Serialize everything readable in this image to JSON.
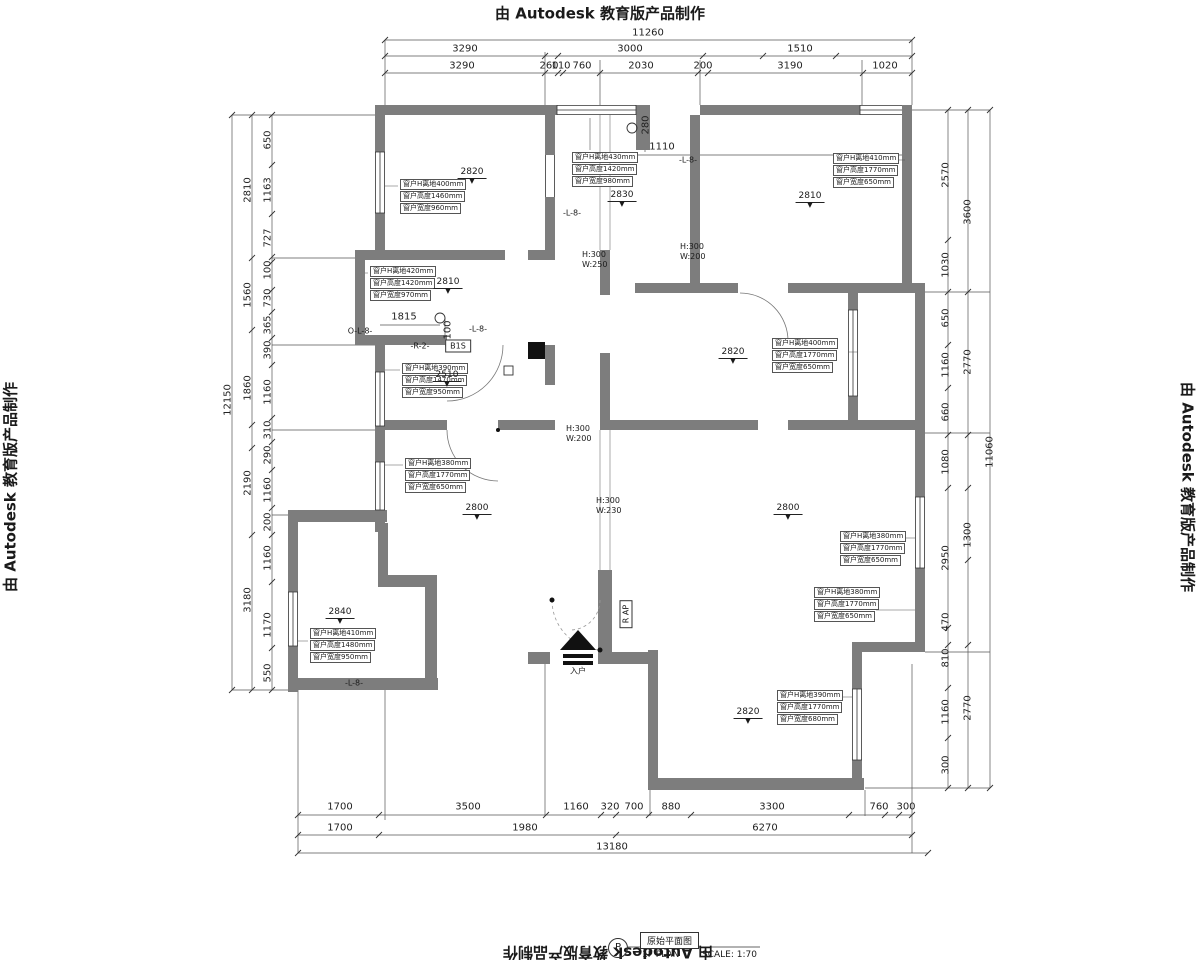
{
  "stamp_text": "由 Autodesk 教育版产品制作",
  "title_block": {
    "circle_letter": "P",
    "drawing_name": "原始平面图",
    "plan_label": "1F PLAN",
    "scale_label": "SCALE: 1:70"
  },
  "colors": {
    "wall": "#7d7d7d",
    "line": "#555555",
    "text": "#1a1a1a"
  },
  "dimensions": {
    "top": [
      {
        "t": "11260",
        "x": 648,
        "y": 33
      },
      {
        "t": "3290",
        "x": 465,
        "y": 49
      },
      {
        "t": "3000",
        "x": 630,
        "y": 49
      },
      {
        "t": "1510",
        "x": 800,
        "y": 49
      },
      {
        "t": "3290",
        "x": 462,
        "y": 66
      },
      {
        "t": "260",
        "x": 549,
        "y": 66
      },
      {
        "t": "110",
        "x": 561,
        "y": 66
      },
      {
        "t": "760",
        "x": 582,
        "y": 66
      },
      {
        "t": "2030",
        "x": 641,
        "y": 66
      },
      {
        "t": "200",
        "x": 703,
        "y": 66
      },
      {
        "t": "3190",
        "x": 790,
        "y": 66
      },
      {
        "t": "1020",
        "x": 885,
        "y": 66
      }
    ],
    "left": [
      {
        "t": "12150",
        "x": 228,
        "y": 400,
        "rot": 1
      },
      {
        "t": "2810",
        "x": 248,
        "y": 190,
        "rot": 1
      },
      {
        "t": "1560",
        "x": 248,
        "y": 295,
        "rot": 1
      },
      {
        "t": "1860",
        "x": 248,
        "y": 388,
        "rot": 1
      },
      {
        "t": "2190",
        "x": 248,
        "y": 483,
        "rot": 1
      },
      {
        "t": "3180",
        "x": 248,
        "y": 600,
        "rot": 1
      },
      {
        "t": "650",
        "x": 268,
        "y": 140,
        "rot": 1
      },
      {
        "t": "1163",
        "x": 268,
        "y": 190,
        "rot": 1
      },
      {
        "t": "727",
        "x": 268,
        "y": 238,
        "rot": 1
      },
      {
        "t": "100",
        "x": 268,
        "y": 270,
        "rot": 1
      },
      {
        "t": "730",
        "x": 268,
        "y": 298,
        "rot": 1
      },
      {
        "t": "365",
        "x": 268,
        "y": 325,
        "rot": 1
      },
      {
        "t": "390",
        "x": 268,
        "y": 350,
        "rot": 1
      },
      {
        "t": "1160",
        "x": 268,
        "y": 392,
        "rot": 1
      },
      {
        "t": "310",
        "x": 268,
        "y": 430,
        "rot": 1
      },
      {
        "t": "290",
        "x": 268,
        "y": 455,
        "rot": 1
      },
      {
        "t": "1160",
        "x": 268,
        "y": 490,
        "rot": 1
      },
      {
        "t": "200",
        "x": 268,
        "y": 522,
        "rot": 1
      },
      {
        "t": "1160",
        "x": 268,
        "y": 558,
        "rot": 1
      },
      {
        "t": "1170",
        "x": 268,
        "y": 625,
        "rot": 1
      },
      {
        "t": "550",
        "x": 268,
        "y": 673,
        "rot": 1
      }
    ],
    "right": [
      {
        "t": "11060",
        "x": 990,
        "y": 452,
        "rot": 1
      },
      {
        "t": "3600",
        "x": 968,
        "y": 212,
        "rot": 1
      },
      {
        "t": "2770",
        "x": 968,
        "y": 362,
        "rot": 1
      },
      {
        "t": "1300",
        "x": 968,
        "y": 535,
        "rot": 1
      },
      {
        "t": "2770",
        "x": 968,
        "y": 708,
        "rot": 1
      },
      {
        "t": "2570",
        "x": 946,
        "y": 175,
        "rot": 1
      },
      {
        "t": "1030",
        "x": 946,
        "y": 265,
        "rot": 1
      },
      {
        "t": "650",
        "x": 946,
        "y": 318,
        "rot": 1
      },
      {
        "t": "1160",
        "x": 946,
        "y": 365,
        "rot": 1
      },
      {
        "t": "660",
        "x": 946,
        "y": 412,
        "rot": 1
      },
      {
        "t": "1080",
        "x": 946,
        "y": 462,
        "rot": 1
      },
      {
        "t": "2950",
        "x": 946,
        "y": 558,
        "rot": 1
      },
      {
        "t": "470",
        "x": 946,
        "y": 622,
        "rot": 1
      },
      {
        "t": "810",
        "x": 946,
        "y": 658,
        "rot": 1
      },
      {
        "t": "1160",
        "x": 946,
        "y": 712,
        "rot": 1
      },
      {
        "t": "300",
        "x": 946,
        "y": 765,
        "rot": 1
      }
    ],
    "bottom": [
      {
        "t": "1700",
        "x": 340,
        "y": 807
      },
      {
        "t": "3500",
        "x": 468,
        "y": 807
      },
      {
        "t": "1160",
        "x": 576,
        "y": 807
      },
      {
        "t": "320",
        "x": 610,
        "y": 807
      },
      {
        "t": "700",
        "x": 634,
        "y": 807
      },
      {
        "t": "880",
        "x": 671,
        "y": 807
      },
      {
        "t": "3300",
        "x": 772,
        "y": 807
      },
      {
        "t": "760",
        "x": 879,
        "y": 807
      },
      {
        "t": "300",
        "x": 906,
        "y": 807
      },
      {
        "t": "1700",
        "x": 340,
        "y": 828
      },
      {
        "t": "1980",
        "x": 525,
        "y": 828
      },
      {
        "t": "6270",
        "x": 765,
        "y": 828
      },
      {
        "t": "13180",
        "x": 612,
        "y": 847
      }
    ],
    "inline": [
      {
        "t": "1110",
        "x": 662,
        "y": 147
      },
      {
        "t": "280",
        "x": 646,
        "y": 125,
        "rot": 1
      },
      {
        "t": "1815",
        "x": 404,
        "y": 317
      },
      {
        "t": "100",
        "x": 448,
        "y": 330,
        "rot": 1
      }
    ]
  },
  "window_labels": [
    {
      "x": 400,
      "y": 179,
      "lines": [
        "窗户H离地400mm",
        "窗户高度1460mm",
        "窗户宽度960mm"
      ]
    },
    {
      "x": 572,
      "y": 152,
      "lines": [
        "窗户H离地430mm",
        "窗户高度1420mm",
        "窗户宽度980mm"
      ]
    },
    {
      "x": 833,
      "y": 153,
      "lines": [
        "窗户H离地410mm",
        "窗户高度1770mm",
        "窗户宽度650mm"
      ]
    },
    {
      "x": 370,
      "y": 266,
      "lines": [
        "窗户H离地420mm",
        "窗户高度1420mm",
        "窗户宽度970mm"
      ]
    },
    {
      "x": 402,
      "y": 363,
      "lines": [
        "窗户H离地390mm",
        "窗户高度1470mm",
        "窗户宽度950mm"
      ]
    },
    {
      "x": 772,
      "y": 338,
      "lines": [
        "窗户H离地400mm",
        "窗户高度1770mm",
        "窗户宽度650mm"
      ]
    },
    {
      "x": 405,
      "y": 458,
      "lines": [
        "窗户H离地380mm",
        "窗户高度1770mm",
        "窗户宽度650mm"
      ]
    },
    {
      "x": 840,
      "y": 531,
      "lines": [
        "窗户H离地380mm",
        "窗户高度1770mm",
        "窗户宽度650mm"
      ]
    },
    {
      "x": 814,
      "y": 587,
      "lines": [
        "窗户H离地380mm",
        "窗户高度1770mm",
        "窗户宽度650mm"
      ]
    },
    {
      "x": 310,
      "y": 628,
      "lines": [
        "窗户H离地410mm",
        "窗户高度1480mm",
        "窗户宽度950mm"
      ]
    },
    {
      "x": 777,
      "y": 690,
      "lines": [
        "窗户H离地390mm",
        "窗户高度1770mm",
        "窗户宽度680mm"
      ]
    }
  ],
  "elevations": [
    {
      "v": "2820",
      "x": 472,
      "y": 168
    },
    {
      "v": "2830",
      "x": 622,
      "y": 191
    },
    {
      "v": "2810",
      "x": 810,
      "y": 192
    },
    {
      "v": "2810",
      "x": 448,
      "y": 278
    },
    {
      "v": "2510",
      "x": 447,
      "y": 371
    },
    {
      "v": "2820",
      "x": 733,
      "y": 348
    },
    {
      "v": "2800",
      "x": 477,
      "y": 504
    },
    {
      "v": "2800",
      "x": 788,
      "y": 504
    },
    {
      "v": "2840",
      "x": 340,
      "y": 608
    },
    {
      "v": "2820",
      "x": 748,
      "y": 708
    }
  ],
  "beam_notes": [
    {
      "x": 582,
      "y": 250,
      "lines": [
        "H:300",
        "W:250"
      ]
    },
    {
      "x": 680,
      "y": 242,
      "lines": [
        "H:300",
        "W:200"
      ]
    },
    {
      "x": 566,
      "y": 424,
      "lines": [
        "H:300",
        "W:200"
      ]
    },
    {
      "x": 596,
      "y": 496,
      "lines": [
        "H:300",
        "W:230"
      ]
    }
  ],
  "tags": [
    {
      "t": "-L-8-",
      "x": 572,
      "y": 213
    },
    {
      "t": "-L-8-",
      "x": 688,
      "y": 160
    },
    {
      "t": "O-L-8-",
      "x": 360,
      "y": 331
    },
    {
      "t": "-L-8-",
      "x": 478,
      "y": 329
    },
    {
      "t": "-R-2-",
      "x": 420,
      "y": 346
    },
    {
      "t": "B1S",
      "x": 458,
      "y": 346,
      "box": 1
    },
    {
      "t": "-L-8-",
      "x": 354,
      "y": 683
    },
    {
      "t": "R AP",
      "x": 626,
      "y": 614,
      "rot": 1,
      "box": 1
    },
    {
      "t": "入户",
      "x": 578,
      "y": 671
    }
  ]
}
